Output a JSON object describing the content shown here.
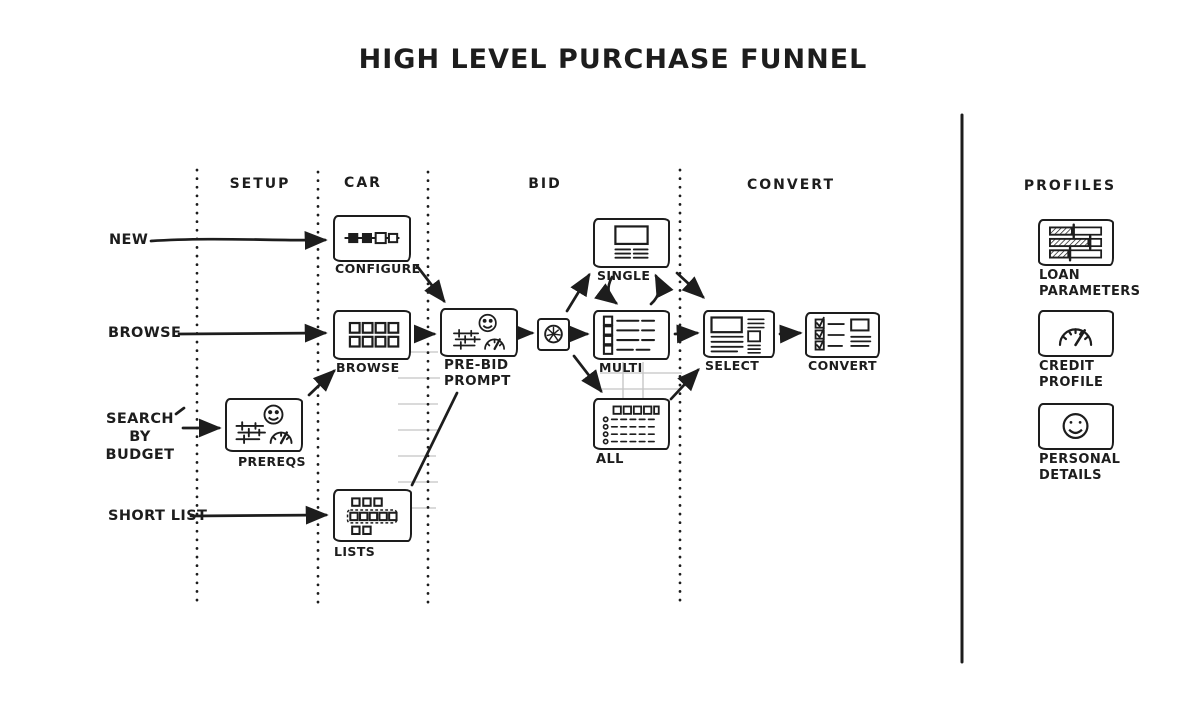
{
  "title": "HIGH LEVEL PURCHASE FUNNEL",
  "columns": {
    "setup": "SETUP",
    "car": "CAR",
    "bid": "BID",
    "convert": "CONVERT"
  },
  "entries": {
    "new": "NEW",
    "browse": "BROWSE",
    "search_by_budget": "SEARCH\nBY BUDGET",
    "short_list": "SHORT LIST"
  },
  "nodes": {
    "configure": {
      "label": "CONFIGURE"
    },
    "browse": {
      "label": "BROWSE"
    },
    "prereqs": {
      "label": "PREREQS"
    },
    "lists": {
      "label": "LISTS"
    },
    "prebid": {
      "label": "PRE-BID\nPROMPT"
    },
    "single": {
      "label": "SINGLE"
    },
    "multi": {
      "label": "MULTI"
    },
    "all": {
      "label": "ALL"
    },
    "select": {
      "label": "SELECT"
    },
    "convert": {
      "label": "CONVERT"
    }
  },
  "profiles": {
    "header": "PROFILES",
    "items": {
      "loan": {
        "label": "LOAN\nPARAMETERS"
      },
      "credit": {
        "label": "CREDIT\nPROFILE"
      },
      "personal": {
        "label": "PERSONAL\nDETAILS"
      }
    }
  },
  "colors": {
    "ink": "#1d1d1d",
    "faint": "#c4c4c4",
    "background": "#ffffff"
  }
}
